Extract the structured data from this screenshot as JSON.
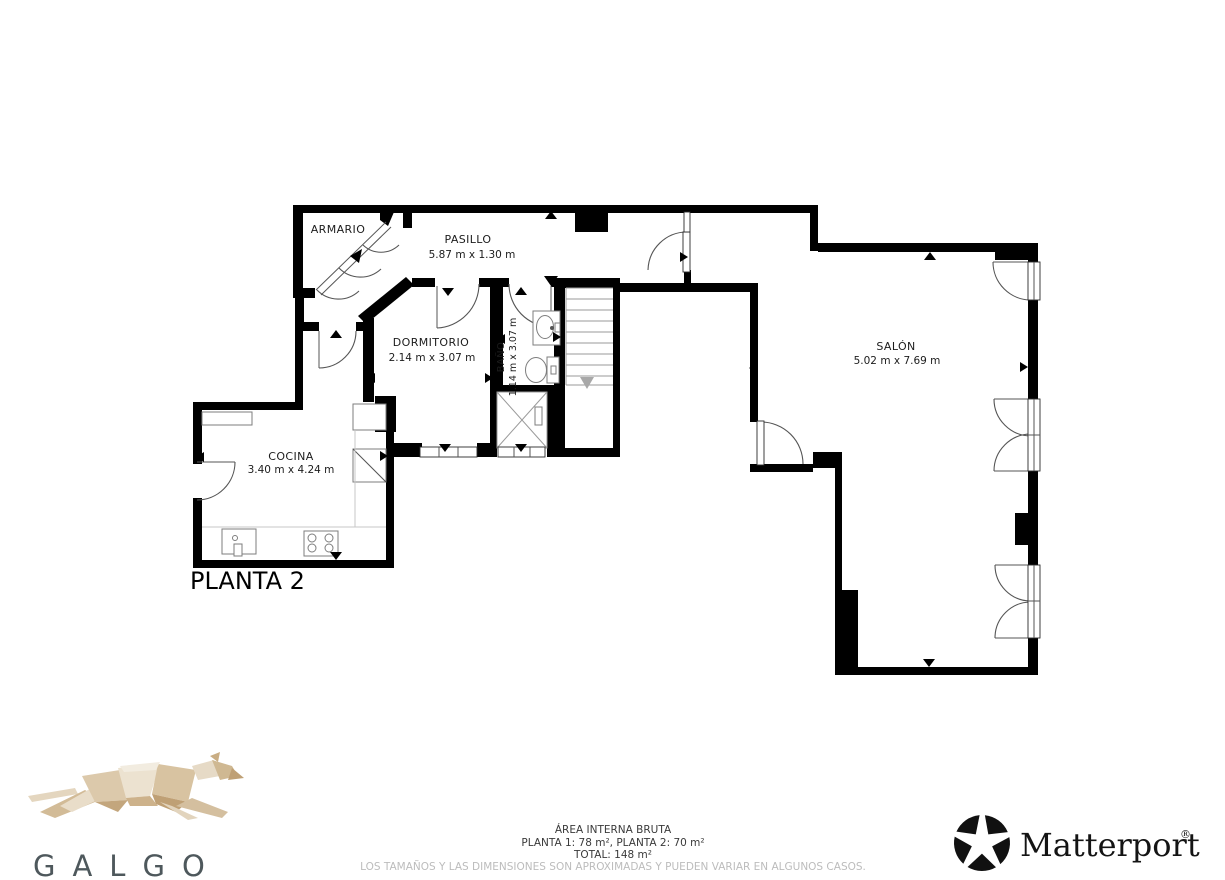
{
  "plan": {
    "floor_label": "PLANTA 2",
    "rooms": {
      "armario": {
        "name": "ARMARIO"
      },
      "pasillo": {
        "name": "PASILLO",
        "dims": "5.87 m x 1.30 m"
      },
      "dormitorio": {
        "name": "DORMITORIO",
        "dims": "2.14 m x 3.07 m"
      },
      "bano": {
        "name": "BAÑO",
        "dims": "1.14 m x 3.07 m"
      },
      "cocina": {
        "name": "COCINA",
        "dims": "3.40 m x 4.24 m"
      },
      "salon": {
        "name": "SALÓN",
        "dims": "5.02 m x 7.69 m"
      }
    }
  },
  "footer": {
    "area_title": "ÁREA INTERNA BRUTA",
    "area_detail": "PLANTA 1: 78 m², PLANTA 2: 70 m²",
    "area_total": "TOTAL: 148 m²",
    "disclaimer": "LOS TAMAÑOS Y LAS DIMENSIONES SON APROXIMADAS Y PUEDEN VARIAR EN ALGUNOS CASOS.",
    "brand_left_wordmark": "GALGO",
    "brand_right_wordmark": "Matterport",
    "brand_right_registered": "®"
  },
  "colors": {
    "wall": "#000000",
    "door_arc": "#555555",
    "disclaimer_text": "#bcbcbc",
    "galgo_text": "#4e585c",
    "dog_light": "#ece2d0",
    "dog_mid": "#d9c5a5",
    "dog_dark": "#c2a47c"
  }
}
